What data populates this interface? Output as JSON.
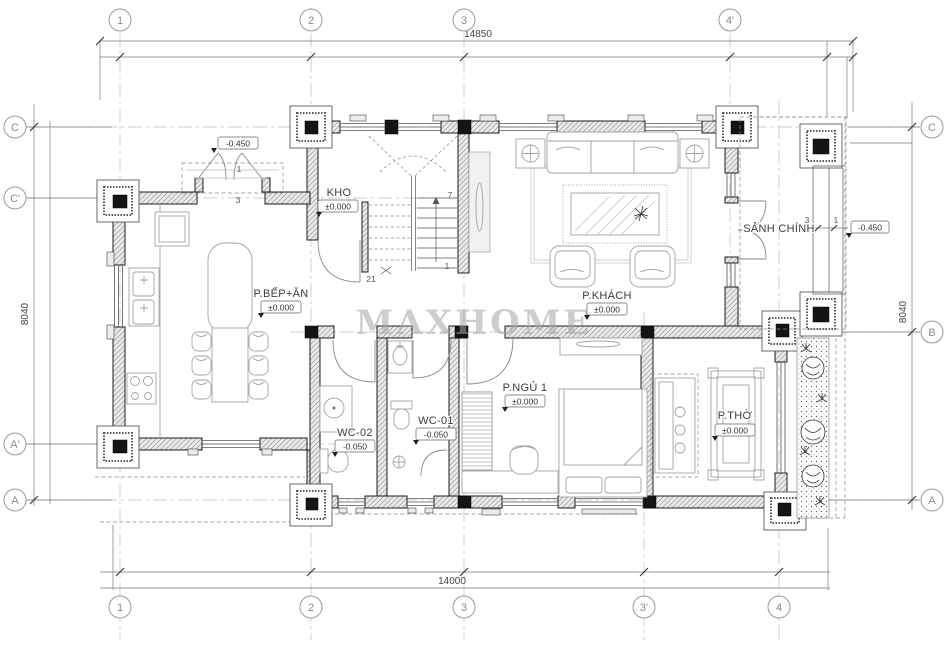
{
  "watermark": "MAXHOME",
  "grid": {
    "top": [
      {
        "label": "1"
      },
      {
        "label": "2"
      },
      {
        "label": "3"
      },
      {
        "label": "4'"
      }
    ],
    "bottom": [
      {
        "label": "1"
      },
      {
        "label": "2"
      },
      {
        "label": "3"
      },
      {
        "label": "3'"
      },
      {
        "label": "4"
      }
    ],
    "left": [
      {
        "label": "C"
      },
      {
        "label": "C'"
      },
      {
        "label": "A'"
      },
      {
        "label": "A"
      }
    ],
    "right": [
      {
        "label": "C"
      },
      {
        "label": "B"
      },
      {
        "label": "A"
      }
    ]
  },
  "dimensions": {
    "top": "14850",
    "bottom": "14000",
    "left": "8040",
    "right": "8040"
  },
  "rooms": [
    {
      "name": "KHO",
      "level": "±0.000"
    },
    {
      "name": "P.BẾP+ĂN",
      "level": "±0.000"
    },
    {
      "name": "P.KHÁCH",
      "level": "±0.000"
    },
    {
      "name": "SẢNH CHÍNH",
      "level": "-0.450"
    },
    {
      "name": "P.NGỦ 1",
      "level": "±0.000"
    },
    {
      "name": "WC-02",
      "level": "-0.050"
    },
    {
      "name": "WC-01",
      "level": "-0.050"
    },
    {
      "name": "P.THỜ",
      "level": "±0.000"
    }
  ],
  "entry": {
    "level": "-0.450",
    "door_marker": "1",
    "step_marker": "3"
  },
  "porch": {
    "left_marker": "3",
    "right_marker": "1"
  },
  "stairs": {
    "top_step": "7",
    "bottom_step": "1",
    "total_steps": "21"
  }
}
